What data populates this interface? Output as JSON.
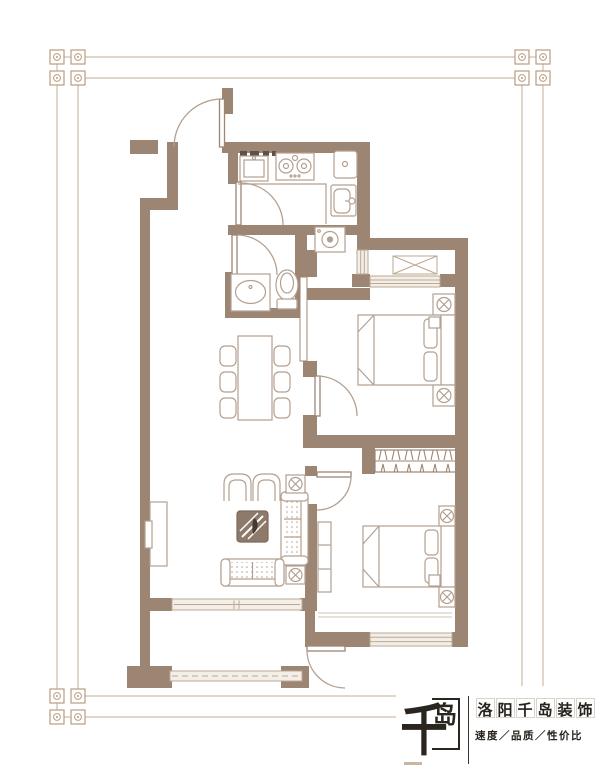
{
  "page": {
    "background": "#ffffff",
    "content": "residential apartment floor plan drawing"
  },
  "brand": {
    "mark_main": "千",
    "mark_sub": "岛",
    "name": "洛阳千岛装饰",
    "tagline": "速度／品质／性价比"
  },
  "palette": {
    "wall": "#9c8573",
    "furniture_line": "#b3a090",
    "window_fill": "#f3eee8",
    "window_line": "#bba993",
    "frame_line": "#cdbaa6",
    "ornament": "#b99d81",
    "coffee_table_dark": "#8d7a6b",
    "logo_text": "#27221d"
  },
  "plan": {
    "rooms": [
      {
        "name": "entry",
        "features": [
          "entry-door"
        ]
      },
      {
        "name": "kitchen",
        "features": [
          "l-counter",
          "sink",
          "two-burner-cooktop",
          "fridge",
          "door"
        ]
      },
      {
        "name": "bathroom",
        "features": [
          "washbasin",
          "toilet",
          "door"
        ]
      },
      {
        "name": "laundry-nook",
        "features": [
          "washing-machine",
          "light-well-window"
        ]
      },
      {
        "name": "dining-area",
        "features": [
          "dining-table",
          "six-chairs"
        ]
      },
      {
        "name": "living-room",
        "features": [
          "sofa",
          "loveseat",
          "two-armchairs",
          "coffee-table-with-plant",
          "tv-cabinet",
          "lamp-side-tables",
          "sliding-door"
        ]
      },
      {
        "name": "bedroom-upper",
        "features": [
          "double-bed",
          "two-nightstand-lamps",
          "bay-window",
          "ac-platform",
          "door"
        ]
      },
      {
        "name": "bedroom-lower",
        "features": [
          "double-bed",
          "two-nightstand-lamps",
          "hanging-wardrobe",
          "dresser",
          "window",
          "door"
        ]
      },
      {
        "name": "balcony",
        "features": [
          "railing-window",
          "corner-columns",
          "door"
        ]
      }
    ]
  }
}
